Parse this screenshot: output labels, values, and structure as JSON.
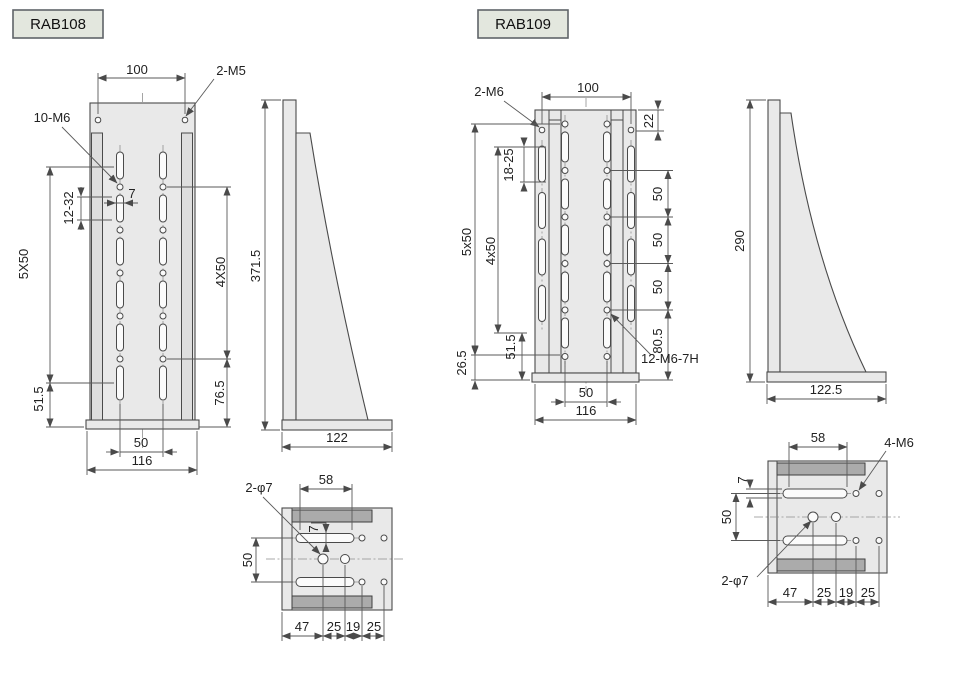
{
  "page": {
    "background": "#ffffff"
  },
  "colors": {
    "part_fill": "#e9e9e9",
    "channel_fill": "#dedede",
    "section_bar_fill": "#ababab",
    "outline": "#4a4a4a",
    "dimension_line": "#5a5a5a",
    "centerline": "#8f8f8f",
    "text": "#222222",
    "label_background": "#e3e7de",
    "label_border": "#5f6468"
  },
  "rab108": {
    "label": "RAB108",
    "front": {
      "d100": "100",
      "m5": "2-M5",
      "m6": "10-M6",
      "d1232": "12-32",
      "d7": "7",
      "d5x50": "5X50",
      "d4x50": "4X50",
      "d515": "51.5",
      "d765": "76.5",
      "d50": "50",
      "d116": "116"
    },
    "side": {
      "height": "371.5",
      "depth": "122"
    },
    "bottom": {
      "phi": "2-φ7",
      "d58": "58",
      "d7": "7",
      "d50": "50",
      "c1": "47",
      "c2": "25",
      "c3": "19",
      "c4": "25"
    }
  },
  "rab109": {
    "label": "RAB109",
    "front": {
      "m6": "2-M6",
      "d100": "100",
      "d22": "22",
      "d1825": "18-25",
      "d5x50": "5x50",
      "d4x50": "4x50",
      "d265": "26.5",
      "d515": "51.5",
      "r50a": "50",
      "r50b": "50",
      "r50c": "50",
      "d805": "80.5",
      "tap": "12-M6-7H",
      "d50": "50",
      "d116": "116"
    },
    "side": {
      "height": "290",
      "depth": "122.5"
    },
    "bottom": {
      "d58": "58",
      "m6": "4-M6",
      "d7": "7",
      "d50": "50",
      "phi": "2-φ7",
      "c1": "47",
      "c2": "25",
      "c3": "19",
      "c4": "25"
    }
  }
}
